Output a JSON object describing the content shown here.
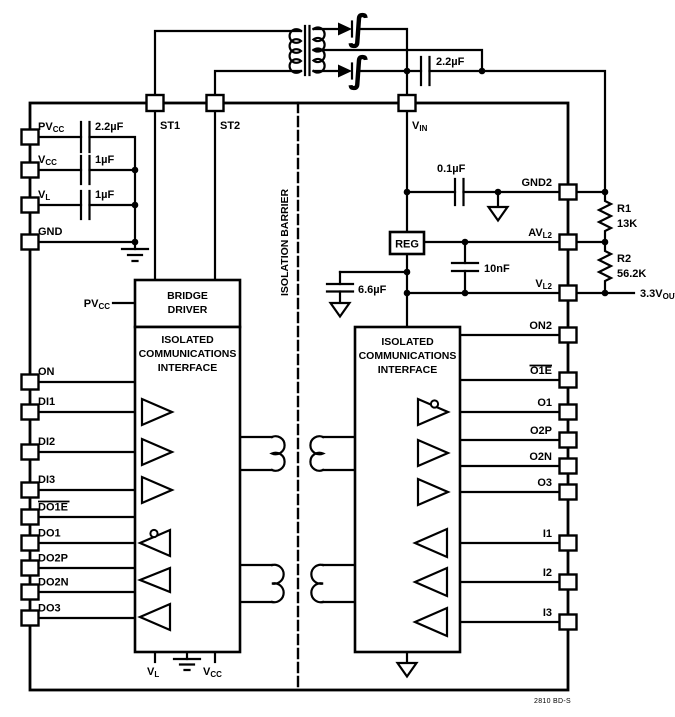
{
  "colors": {
    "ink": "#000000",
    "paper": "#ffffff"
  },
  "figure_tag": "2810 BD-S",
  "barrier_label": "ISOLATION BARRIER",
  "blocks": {
    "bridge_driver": [
      "BRIDGE",
      "DRIVER"
    ],
    "left_interface": [
      "ISOLATED",
      "COMMUNICATIONS",
      "INTERFACE"
    ],
    "right_interface": [
      "ISOLATED",
      "COMMUNICATIONS",
      "INTERFACE"
    ],
    "regulator": "REG"
  },
  "pins": {
    "st1": {
      "main": "ST1"
    },
    "st2": {
      "main": "ST2"
    },
    "vin": {
      "main": "V",
      "sub": "IN"
    },
    "pvcc": {
      "main": "PV",
      "sub": "CC"
    },
    "vcc": {
      "main": "V",
      "sub": "CC"
    },
    "vl": {
      "main": "V",
      "sub": "L"
    },
    "gnd": {
      "main": "GND"
    },
    "on": {
      "main": "ON"
    },
    "di1": {
      "main": "DI1"
    },
    "di2": {
      "main": "DI2"
    },
    "di3": {
      "main": "DI3"
    },
    "do1e": {
      "main": "DO1E"
    },
    "do1": {
      "main": "DO1"
    },
    "do2p": {
      "main": "DO2P"
    },
    "do2n": {
      "main": "DO2N"
    },
    "do3": {
      "main": "DO3"
    },
    "gnd2": {
      "main": "GND2"
    },
    "avl2": {
      "main": "AV",
      "sub": "L2"
    },
    "vl2": {
      "main": "V",
      "sub": "L2"
    },
    "on2": {
      "main": "ON2"
    },
    "o1e": {
      "main": "O1E"
    },
    "o1": {
      "main": "O1"
    },
    "o2p": {
      "main": "O2P"
    },
    "o2n": {
      "main": "O2N"
    },
    "o3": {
      "main": "O3"
    },
    "i1": {
      "main": "I1"
    },
    "i2": {
      "main": "I2"
    },
    "i3": {
      "main": "I3"
    }
  },
  "components": {
    "c_top": "2.2µF",
    "c_pvcc": "2.2µF",
    "c_vcc": "1µF",
    "c_vl": "1µF",
    "c_gnd2": "0.1µF",
    "c_reg": "6.6µF",
    "c_avl2": "10nF",
    "r1_name": "R1",
    "r1_value": "13K",
    "r2_name": "R2",
    "r2_value": "56.2K"
  },
  "labels": {
    "vout": {
      "main": "3.3V",
      "sub": "OUT"
    },
    "pvcc_feed": {
      "main": "PV",
      "sub": "CC"
    },
    "bottom_vl": {
      "main": "V",
      "sub": "L"
    },
    "bottom_vcc": {
      "main": "V",
      "sub": "CC"
    }
  },
  "icons": {
    "rectifier_squiggle": "∫"
  }
}
